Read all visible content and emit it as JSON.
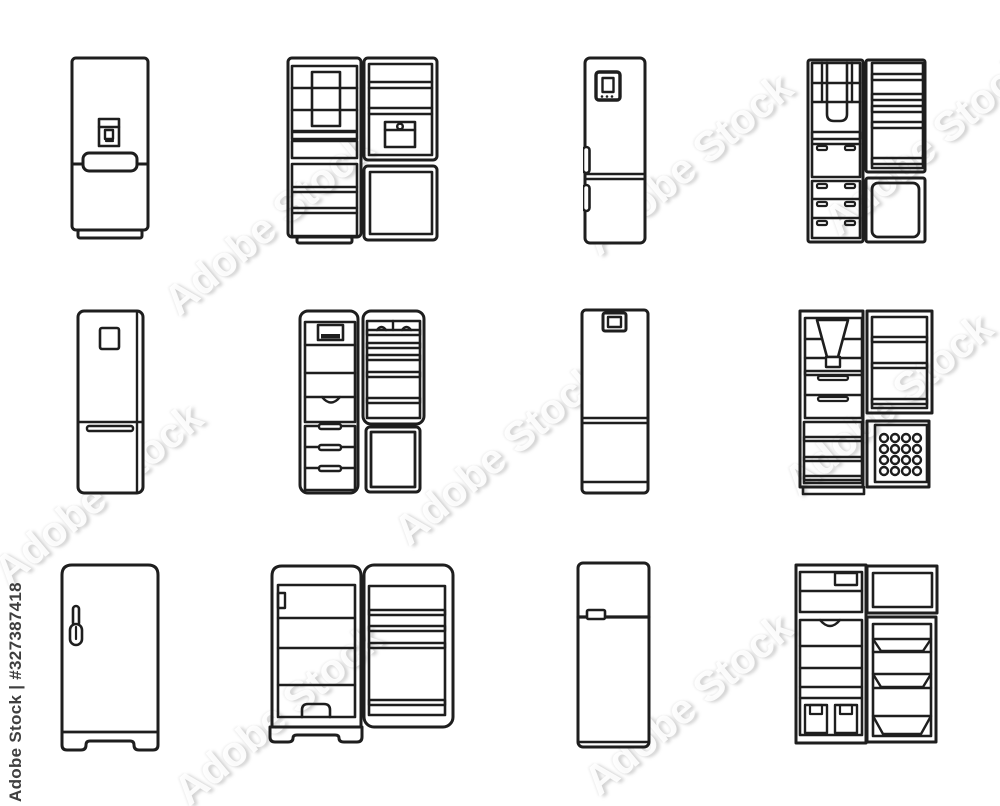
{
  "canvas": {
    "background": "#ffffff",
    "stroke_color": "#1e1e1e",
    "width": 1000,
    "height": 806
  },
  "watermark": {
    "vertical_text": "Adobe Stock | #327387418",
    "diagonal_text": "Adobe Stock"
  },
  "icons": [
    {
      "id": "fridge-dispenser-closed",
      "label": "Two-door refrigerator with water dispenser, closed"
    },
    {
      "id": "fridge-open-icebox",
      "label": "Open refrigerator with shelves, ice box and freezer door"
    },
    {
      "id": "fridge-display-closed",
      "label": "Tall refrigerator with digital display and side handles, closed"
    },
    {
      "id": "fridge-open-drawers",
      "label": "Open refrigerator with door bins, drawers and freezer compartment"
    },
    {
      "id": "fridge-panel-closed",
      "label": "Bottom-freezer refrigerator with control panel, closed"
    },
    {
      "id": "fridge-open-bottom-freezer",
      "label": "Open refrigerator with drawers, shelves and bottom freezer"
    },
    {
      "id": "fridge-top-control-closed",
      "label": "Refrigerator with top control box, closed"
    },
    {
      "id": "fridge-open-ice-tray",
      "label": "Open refrigerator with funnel dispenser, drawers and ice cube tray"
    },
    {
      "id": "fridge-retro-closed",
      "label": "Retro single-door refrigerator with latch handle, closed"
    },
    {
      "id": "fridge-retro-open",
      "label": "Open retro refrigerator with shelves and door bins"
    },
    {
      "id": "fridge-top-freezer-closed",
      "label": "Top-freezer refrigerator with handle, closed"
    },
    {
      "id": "fridge-top-freezer-open",
      "label": "Open top-freezer refrigerator with shelves and door bins"
    }
  ]
}
